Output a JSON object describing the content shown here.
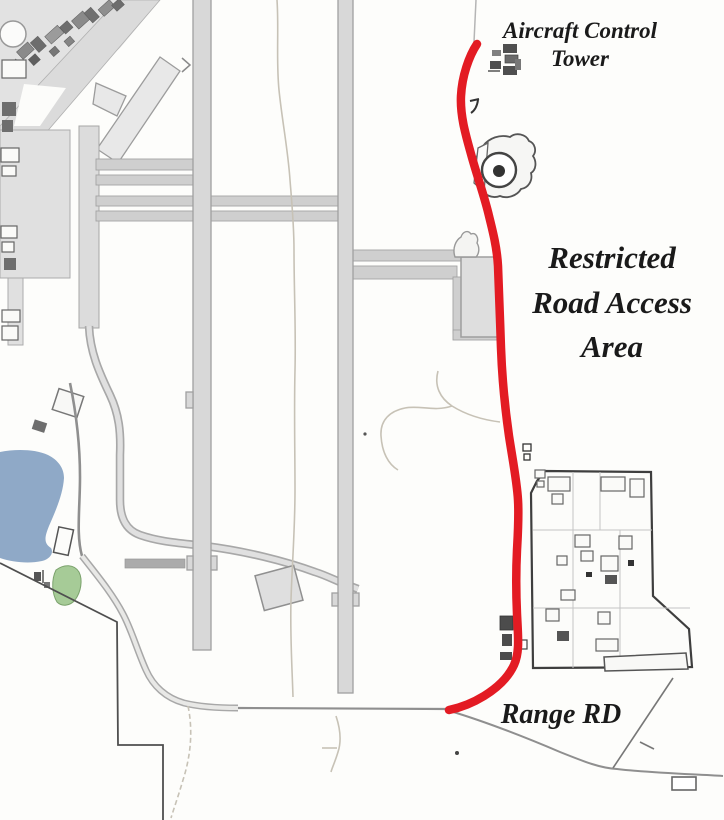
{
  "map": {
    "labels": {
      "aircraft_control_tower": {
        "line1": "Aircraft Control",
        "line2": "Tower"
      },
      "restricted_area": {
        "line1": "Restricted",
        "line2": "Road Access",
        "line3": "Area"
      },
      "range_road": {
        "text": "Range RD"
      }
    },
    "colors": {
      "restricted_route_red": "#E31B23",
      "pond_blue": "#8FA9C7",
      "vegetation_green": "#A6CB97",
      "pavement_gray": "#D8D8D8",
      "label_text": "#1A1A1A",
      "background": "#FDFDFB"
    },
    "features": {
      "route_name": "restricted-road-access-route",
      "water_name": "pond",
      "compound_name": "range-facility-compound",
      "tower_name": "aircraft-control-tower"
    }
  }
}
